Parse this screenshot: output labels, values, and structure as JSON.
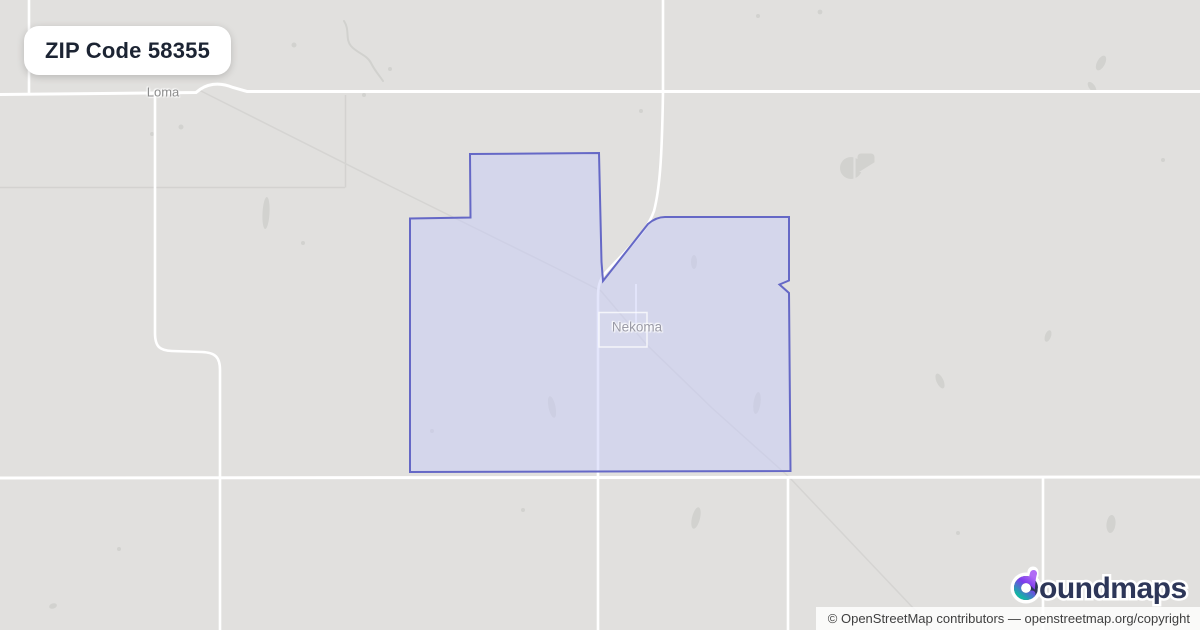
{
  "badge": {
    "label": "ZIP Code 58355"
  },
  "map": {
    "towns": [
      {
        "name": "Loma"
      },
      {
        "name": "Nekoma"
      }
    ]
  },
  "logo": {
    "brand": "boundmaps",
    "text_after_mark": "oundmaps"
  },
  "attribution": {
    "text": "© OpenStreetMap contributors — openstreetmap.org/copyright"
  },
  "colors": {
    "map_base": "#e1e0de",
    "boundary_stroke": "#6568c6",
    "boundary_fill": "rgba(200,203,248,0.5)",
    "road": "#ffffff",
    "badge_text": "#1c2433",
    "logo_navy": "#2d3658",
    "logo_purple": "#a855f7",
    "logo_teal": "#14b8a6"
  }
}
